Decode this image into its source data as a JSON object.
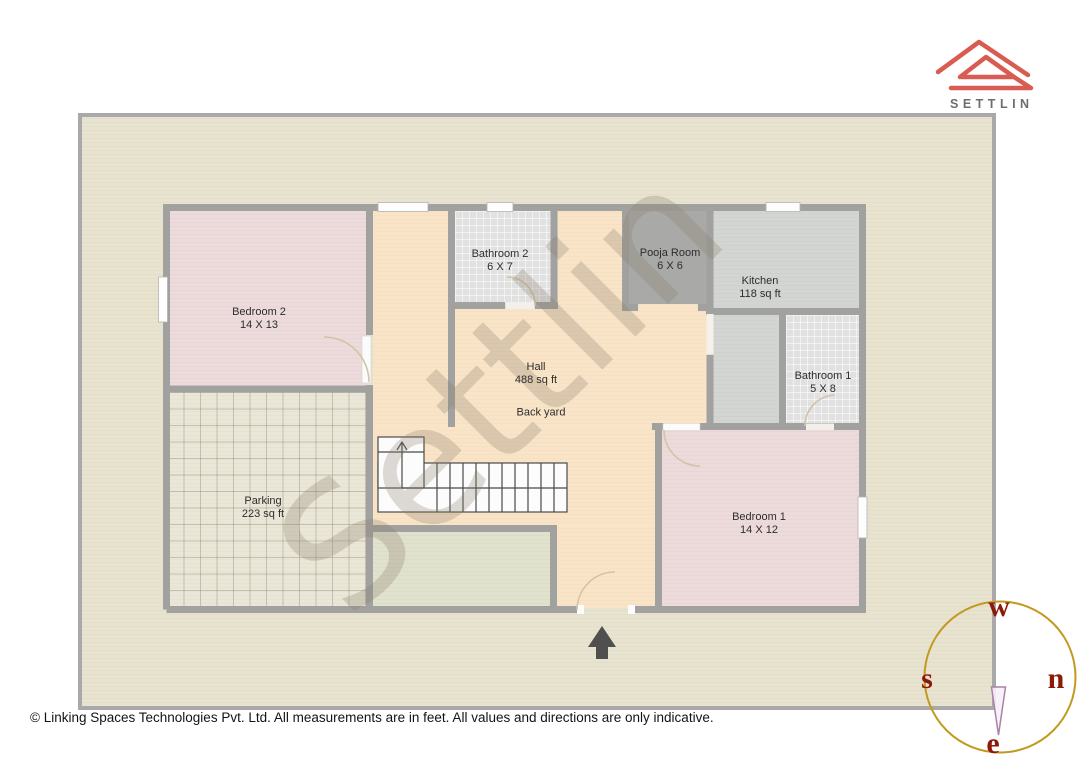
{
  "branding": {
    "logo_text": "SETTLIN",
    "logo_icon": "settlin-roof-logo",
    "logo_color": "#d85c52"
  },
  "watermark": {
    "text": "Settlin"
  },
  "rooms": [
    {
      "name": "Bedroom 2",
      "size": "14 X 13"
    },
    {
      "name": "Bathroom 2",
      "size": "6 X 7"
    },
    {
      "name": "Pooja Room",
      "size": "6 X 6"
    },
    {
      "name": "Kitchen",
      "size": "118 sq ft"
    },
    {
      "name": "Bathroom 1",
      "size": "5 X 8"
    },
    {
      "name": "Hall",
      "size": "488 sq ft"
    },
    {
      "name": "Back yard",
      "size": ""
    },
    {
      "name": "Parking",
      "size": "223 sq ft"
    },
    {
      "name": "Bedroom 1",
      "size": "14 X 12"
    }
  ],
  "compass": {
    "top": "w",
    "right": "n",
    "left": "s",
    "bottom": "e",
    "circle_color": "#c39a20",
    "letter_color": "#8c1a0a"
  },
  "footer": {
    "copyright": "© Linking Spaces Technologies Pvt. Ltd. All measurements are in feet. All values and directions are only indicative."
  },
  "colors": {
    "plot_fill": "#e7e3ce",
    "wall": "#a1a19f",
    "hall_fill": "#f9e4c8",
    "bedroom_fill": "#eddbdc",
    "kitchen_fill": "#d3d5d2",
    "entrance_arrow": "#4f4f4f"
  }
}
